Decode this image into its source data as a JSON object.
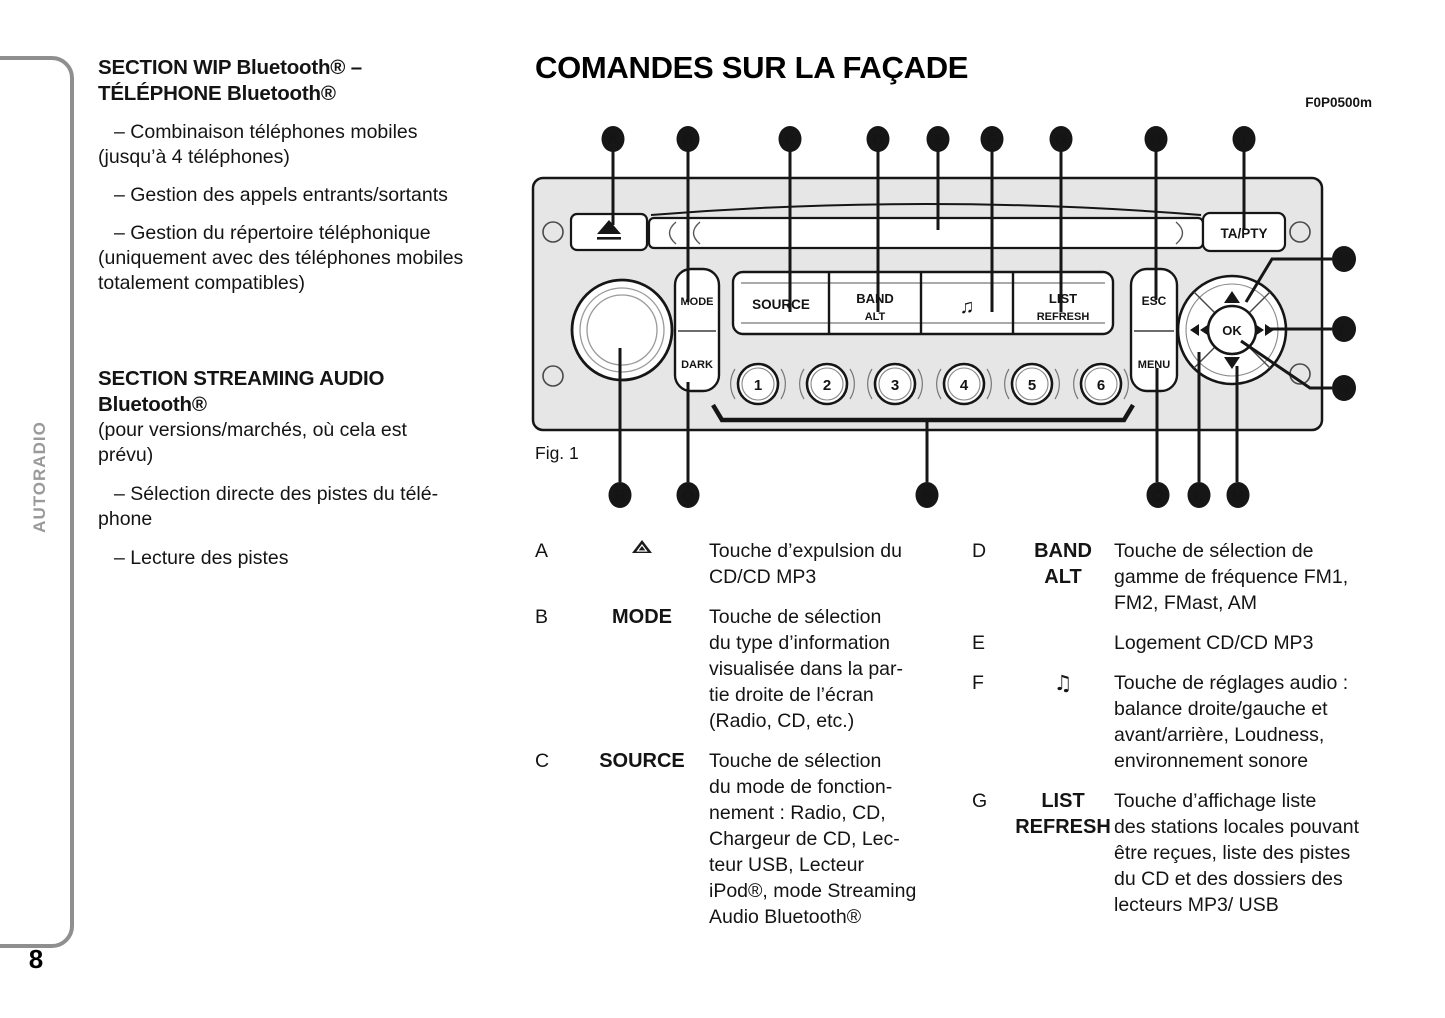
{
  "sidebar": {
    "section_label": "AUTORADIO",
    "page_number": "8"
  },
  "intro": {
    "heading1": [
      "SECTION WIP Bluetooth® –",
      "TÉLÉPHONE Bluetooth®"
    ],
    "items1": [
      [
        "– Combinaison téléphones mobiles",
        "(jusqu’à 4 téléphones)"
      ],
      [
        "– Gestion des appels entrants/sortants"
      ],
      [
        "– Gestion du répertoire téléphonique",
        "(uniquement avec des téléphones mobiles",
        "totalement compatibles)"
      ]
    ],
    "heading2": [
      "SECTION STREAMING AUDIO",
      "Bluetooth®"
    ],
    "subnote": [
      "(pour versions/marchés, où cela est",
      "prévu)"
    ],
    "items2": [
      [
        "– Sélection directe des pistes du télé-",
        "phone"
      ],
      [
        "– Lecture des pistes"
      ]
    ]
  },
  "header": {
    "title": "COMANDES SUR LA FAÇADE",
    "figure_code": "F0P0500m"
  },
  "figure": {
    "label": "Fig. 1",
    "callouts_top": [
      "A",
      "B",
      "C",
      "D",
      "E",
      "F",
      "G",
      "H",
      "I"
    ],
    "callouts_right": [
      "M",
      "L",
      "N"
    ],
    "callouts_bottom": [
      "R",
      "Q",
      "P",
      "O",
      "L",
      "M"
    ],
    "radio": {
      "ta_pty": "TA/PTY",
      "mode": "MODE",
      "dark": "DARK",
      "source": "SOURCE",
      "band": "BAND",
      "alt": "ALT",
      "audio_note": "♫",
      "list": "LIST",
      "refresh": "REFRESH",
      "esc": "ESC",
      "menu": "MENU",
      "ok": "OK",
      "presets": [
        "1",
        "2",
        "3",
        "4",
        "5",
        "6"
      ]
    }
  },
  "legend": {
    "left": [
      {
        "letter": "A",
        "icon": "eject-icon",
        "label": "",
        "lines": [
          "Touche d’expulsion du",
          "CD/CD MP3"
        ]
      },
      {
        "letter": "B",
        "label": "MODE",
        "lines": [
          "Touche de sélection",
          "du type d’information",
          "visualisée dans la par-",
          "tie droite de l’écran",
          "(Radio, CD, etc.)"
        ]
      },
      {
        "letter": "C",
        "label": "SOURCE",
        "lines": [
          "Touche de sélection",
          "du mode de fonction-",
          "nement : Radio, CD,",
          "Chargeur de CD, Lec-",
          "teur USB, Lecteur",
          "iPod®, mode Streaming",
          "Audio Bluetooth®"
        ]
      }
    ],
    "right": [
      {
        "letter": "D",
        "label": [
          "BAND",
          "ALT"
        ],
        "lines": [
          "Touche de sélection de",
          "gamme de fréquence FM1,",
          "FM2, FMast, AM"
        ]
      },
      {
        "letter": "E",
        "label": "",
        "lines": [
          "Logement CD/CD MP3"
        ]
      },
      {
        "letter": "F",
        "icon": "music-note-icon",
        "label": "♫",
        "lines": [
          "Touche de réglages audio :",
          "balance droite/gauche et",
          "avant/arrière, Loudness,",
          "environnement sonore"
        ]
      },
      {
        "letter": "G",
        "label": [
          "LIST",
          "REFRESH"
        ],
        "lines": [
          "Touche d’affichage liste",
          "des stations locales pouvant",
          "être reçues, liste des pistes",
          "du CD et des dossiers des",
          "lecteurs MP3/ USB"
        ]
      }
    ]
  }
}
